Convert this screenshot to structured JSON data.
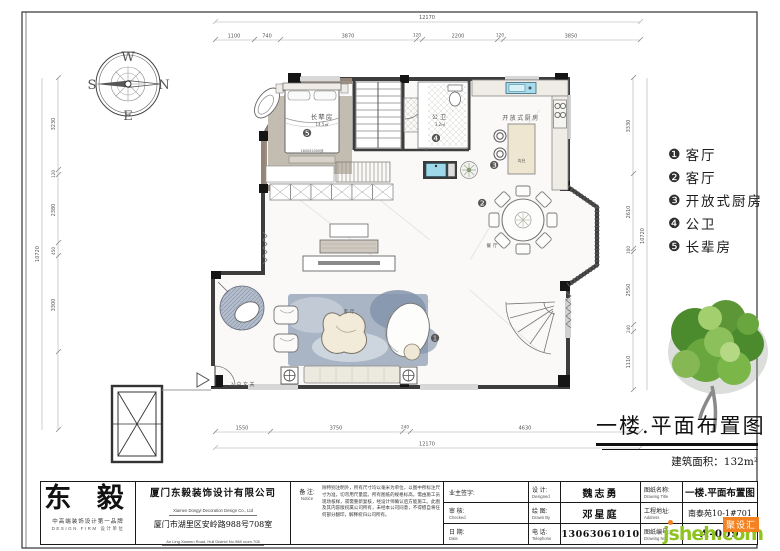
{
  "compass": {
    "w": "W",
    "s": "S",
    "n": "N",
    "e": "E"
  },
  "dims": {
    "top_total": "12170",
    "top_segments": [
      "1100",
      "740",
      "3870",
      "120",
      "2200",
      "120",
      "3850"
    ],
    "bottom_segments": [
      "1550",
      "3750",
      "240",
      "4630"
    ],
    "bottom_total": "12170",
    "left_total": "10720",
    "left_segments": [
      "3230",
      "120",
      "2380",
      "450",
      "3300"
    ],
    "right_total": "10720",
    "right_segments": [
      "3330",
      "2610",
      "100",
      "2550",
      "240",
      "1110"
    ]
  },
  "plan": {
    "rooms": {
      "elder_room": {
        "name": "长辈房",
        "area": "14.5㎡",
        "marker": "❺"
      },
      "bath": {
        "name": "公卫",
        "area": "3.2㎡",
        "marker": "❹"
      },
      "kitchen": {
        "name": "开放式厨房",
        "marker": "❸"
      },
      "dining": {
        "name": "餐厅",
        "marker": "❷"
      },
      "living": {
        "name": "客厅",
        "marker": "❶"
      },
      "foyer": {
        "name": "入户玄关"
      }
    },
    "annotations": {
      "bed_size": "1800X2000床",
      "island": "岛台"
    }
  },
  "legend": {
    "items": [
      {
        "num": "❶",
        "label": "客厅"
      },
      {
        "num": "❷",
        "label": "客厅"
      },
      {
        "num": "❸",
        "label": "开放式厨房"
      },
      {
        "num": "❹",
        "label": "公卫"
      },
      {
        "num": "❺",
        "label": "长辈房"
      }
    ]
  },
  "title": {
    "main": "一楼.平面布置图",
    "area": "建筑面积：132m²"
  },
  "titleblock": {
    "logo": {
      "name": "东 毅",
      "tagline": "中高端装饰设计第一品牌",
      "sub": "DESIGN FIRM  设计单位"
    },
    "company": {
      "name": "厦门东毅装饰设计有限公司",
      "name_en": "Xiamen Dongyi Decoration Design Co., Ltd",
      "address": "厦门市湖里区安岭路988号708室",
      "address_en": "An Ling Xiamen Road, Huli District No.988 room 708",
      "postal": "邮编: 3610000",
      "tel": "电话: 0592-5331210",
      "fax": "传真: 0592-5331210"
    },
    "notice": {
      "label": "备 注:",
      "label_en": "Notice",
      "text": "除特别注明外，所有尺寸均以毫米为单位，以图中所标注尺寸为准，切勿用尺量度。所有图纸的规格标高，需由施工员现场核样，或需重新复核，经设计师确认后方能施工。此图及其内容版权属公司所有，未经本公司同意，不得擅自将任何部分翻印，解释权归公司所有。"
    },
    "sign": {
      "owner_label": "业主签字:",
      "check_label": "审  核:",
      "check_en": "Checked",
      "date_label": "日  期:",
      "date_en": "Date"
    },
    "staff": {
      "design_label": "设  计:",
      "design_en": "Designed",
      "designer": "魏志勇",
      "draw_label": "绘  图:",
      "draw_en": "Drawn By",
      "drafter": "邓星庭",
      "tel_label": "电  话:",
      "tel_en": "Telephone",
      "tel": "13063061010"
    },
    "drawing": {
      "title_label": "图纸名称:",
      "title_en": "Drawing Title",
      "title": "一楼.平面布置图",
      "addr_label": "工程地址:",
      "addr_en": "Address",
      "addr": "南泰苑10-1#701",
      "no_label": "图纸编号:",
      "no_en": "Drawing No",
      "no": "A-009"
    }
  },
  "watermark": {
    "site": "jsheh.com",
    "badge": "聚设汇"
  }
}
